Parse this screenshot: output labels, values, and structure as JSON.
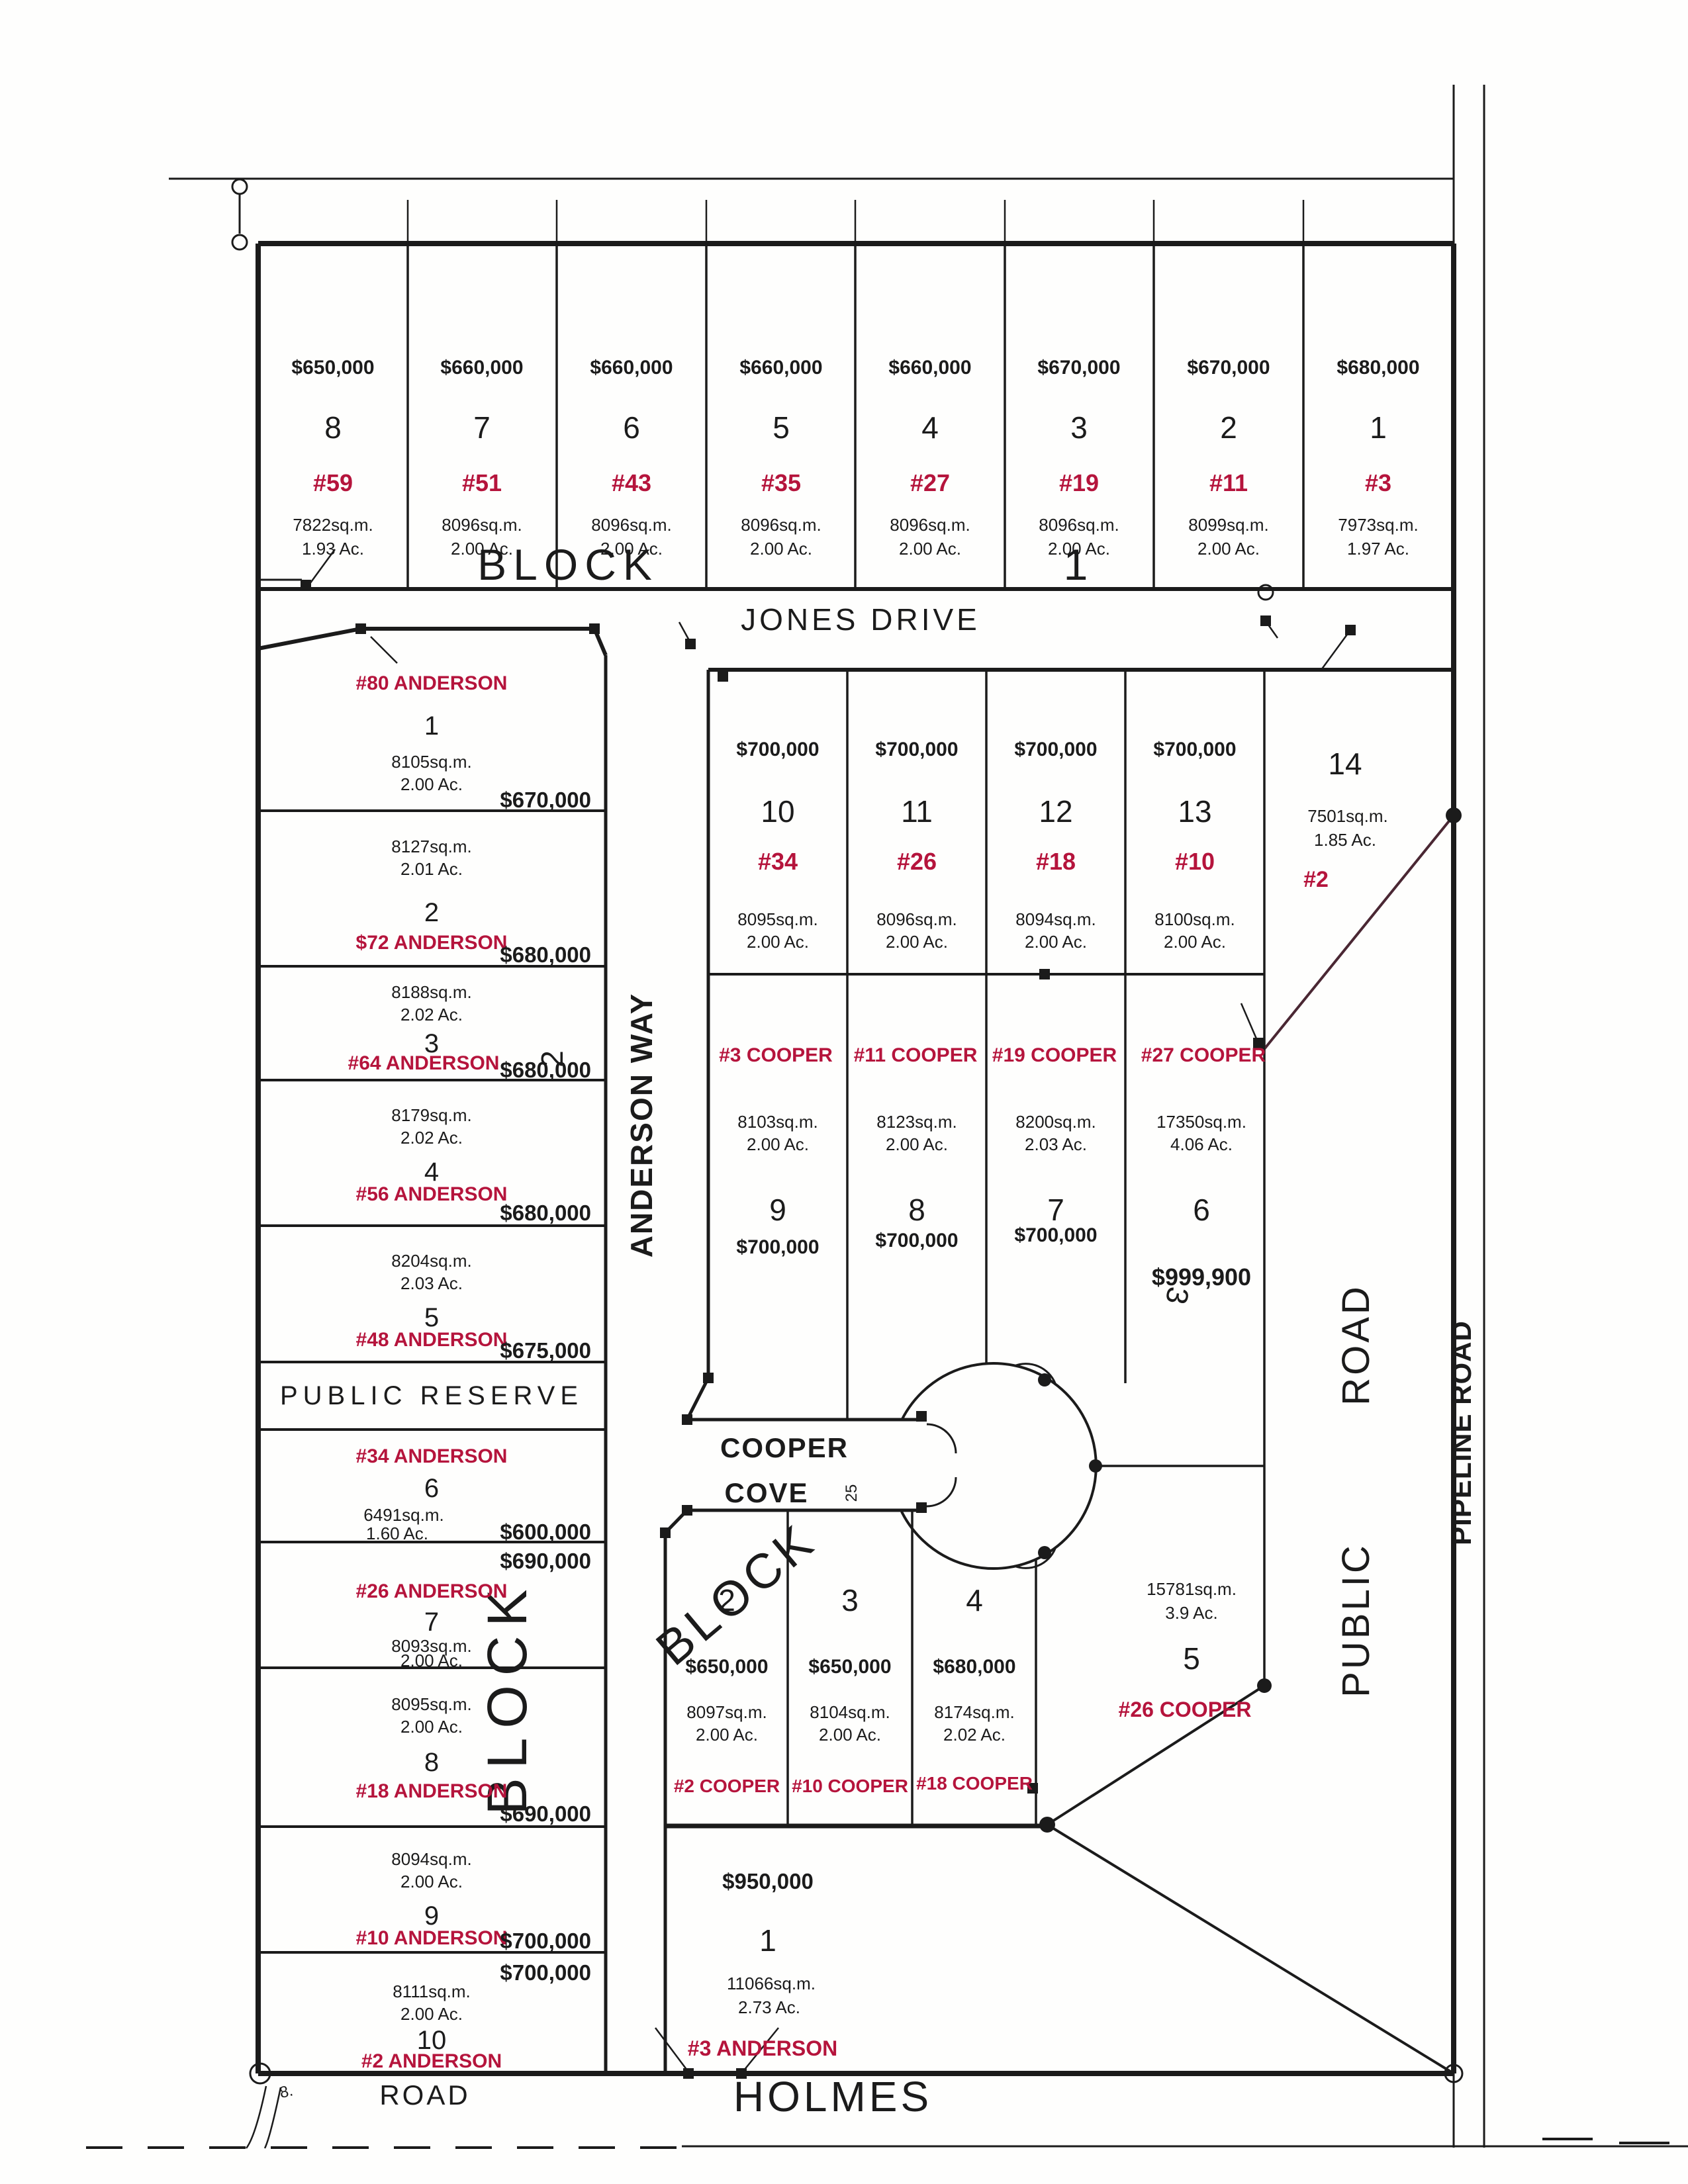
{
  "colors": {
    "red": "#b5143c",
    "ink": "#1b1b1b",
    "maroon": "#4a2733"
  },
  "blocks": {
    "block_word": "BLOCK",
    "b1": "1",
    "b2": "2",
    "b3": "3",
    "public_reserve": "PUBLIC RESERVE"
  },
  "roads": {
    "jones": "JONES DRIVE",
    "anderson_way": "ANDERSON WAY",
    "cooper": "COOPER",
    "cove": "COVE",
    "cove_width": "25",
    "public_word1": "PUBLIC",
    "public_word2": "ROAD",
    "pipeline": "PIPELINE ROAD",
    "holmes": "HOLMES",
    "holmes_road": "ROAD",
    "corner_mark": "8."
  },
  "b1": [
    {
      "num": "8",
      "price": "$650,000",
      "addr": "#59",
      "sqm": "7822sq.m.",
      "ac": "1.93 Ac."
    },
    {
      "num": "7",
      "price": "$660,000",
      "addr": "#51",
      "sqm": "8096sq.m.",
      "ac": "2.00 Ac."
    },
    {
      "num": "6",
      "price": "$660,000",
      "addr": "#43",
      "sqm": "8096sq.m.",
      "ac": "2.00 Ac."
    },
    {
      "num": "5",
      "price": "$660,000",
      "addr": "#35",
      "sqm": "8096sq.m.",
      "ac": "2.00 Ac."
    },
    {
      "num": "4",
      "price": "$660,000",
      "addr": "#27",
      "sqm": "8096sq.m.",
      "ac": "2.00 Ac."
    },
    {
      "num": "3",
      "price": "$670,000",
      "addr": "#19",
      "sqm": "8096sq.m.",
      "ac": "2.00 Ac."
    },
    {
      "num": "2",
      "price": "$670,000",
      "addr": "#11",
      "sqm": "8099sq.m.",
      "ac": "2.00 Ac."
    },
    {
      "num": "1",
      "price": "$680,000",
      "addr": "#3",
      "sqm": "7973sq.m.",
      "ac": "1.97 Ac."
    }
  ],
  "b2": [
    {
      "addr": "#80 ANDERSON",
      "num": "1",
      "sqm": "8105sq.m.",
      "ac": "2.00 Ac.",
      "price": "$670,000"
    },
    {
      "sqm": "8127sq.m.",
      "ac": "2.01 Ac.",
      "num": "2",
      "addr": "$72 ANDERSON",
      "price": "$680,000"
    },
    {
      "sqm": "8188sq.m.",
      "ac": "2.02 Ac.",
      "num": "3",
      "addr": "#64 ANDERSON",
      "price": "$680,000"
    },
    {
      "sqm": "8179sq.m.",
      "ac": "2.02 Ac.",
      "num": "4",
      "addr": "#56 ANDERSON",
      "price": "$680,000"
    },
    {
      "sqm": "8204sq.m.",
      "ac": "2.03 Ac.",
      "num": "5",
      "addr": "#48 ANDERSON",
      "price": "$675,000"
    },
    {
      "addr": "#34 ANDERSON",
      "num": "6",
      "sqm": "6491sq.m.",
      "ac": "1.60 Ac.",
      "price": "$600,000"
    },
    {
      "price": "$690,000",
      "addr": "#26 ANDERSON",
      "num": "7",
      "sqm": "8093sq.m.",
      "ac": "2.00 Ac."
    },
    {
      "sqm": "8095sq.m.",
      "ac": "2.00 Ac.",
      "num": "8",
      "addr": "#18 ANDERSON",
      "price": "$690,000"
    },
    {
      "sqm": "8094sq.m.",
      "ac": "2.00 Ac.",
      "num": "9",
      "addr": "#10 ANDERSON",
      "price": "$700,000"
    },
    {
      "price": "$700,000",
      "sqm": "8111sq.m.",
      "ac": "2.00 Ac.",
      "num": "10",
      "addr": "#2 ANDERSON"
    }
  ],
  "row": [
    {
      "price": "$700,000",
      "num": "10",
      "addr": "#34",
      "sqm": "8095sq.m.",
      "ac": "2.00 Ac."
    },
    {
      "price": "$700,000",
      "num": "11",
      "addr": "#26",
      "sqm": "8096sq.m.",
      "ac": "2.00 Ac."
    },
    {
      "price": "$700,000",
      "num": "12",
      "addr": "#18",
      "sqm": "8094sq.m.",
      "ac": "2.00 Ac."
    },
    {
      "price": "$700,000",
      "num": "13",
      "addr": "#10",
      "sqm": "8100sq.m.",
      "ac": "2.00 Ac."
    }
  ],
  "lot14": {
    "num": "14",
    "sqm": "7501sq.m.",
    "ac": "1.85 Ac.",
    "addr": "#2"
  },
  "cooper": [
    {
      "addr": "#3 COOPER",
      "sqm": "8103sq.m.",
      "ac": "2.00 Ac.",
      "num": "9",
      "price": "$700,000"
    },
    {
      "addr": "#11 COOPER",
      "sqm": "8123sq.m.",
      "ac": "2.00 Ac.",
      "num": "8",
      "price": "$700,000"
    },
    {
      "addr": "#19 COOPER",
      "sqm": "8200sq.m.",
      "ac": "2.03 Ac.",
      "num": "7",
      "price": "$700,000"
    },
    {
      "addr": "#27 COOPER",
      "sqm": "17350sq.m.",
      "ac": "4.06 Ac.",
      "num": "6",
      "price": "$999,900"
    }
  ],
  "b3": [
    {
      "num": "2",
      "price": "$650,000",
      "sqm": "8097sq.m.",
      "ac": "2.00 Ac.",
      "addr": "#2 COOPER"
    },
    {
      "num": "3",
      "price": "$650,000",
      "sqm": "8104sq.m.",
      "ac": "2.00 Ac.",
      "addr": "#10 COOPER"
    },
    {
      "num": "4",
      "price": "$680,000",
      "sqm": "8174sq.m.",
      "ac": "2.02 Ac.",
      "addr": "#18 COOPER"
    }
  ],
  "lot5": {
    "sqm": "15781sq.m.",
    "ac": "3.9 Ac.",
    "num": "5",
    "addr": "#26 COOPER"
  },
  "lot1": {
    "price": "$950,000",
    "num": "1",
    "sqm": "11066sq.m.",
    "ac": "2.73 Ac.",
    "addr": "#3 ANDERSON"
  }
}
